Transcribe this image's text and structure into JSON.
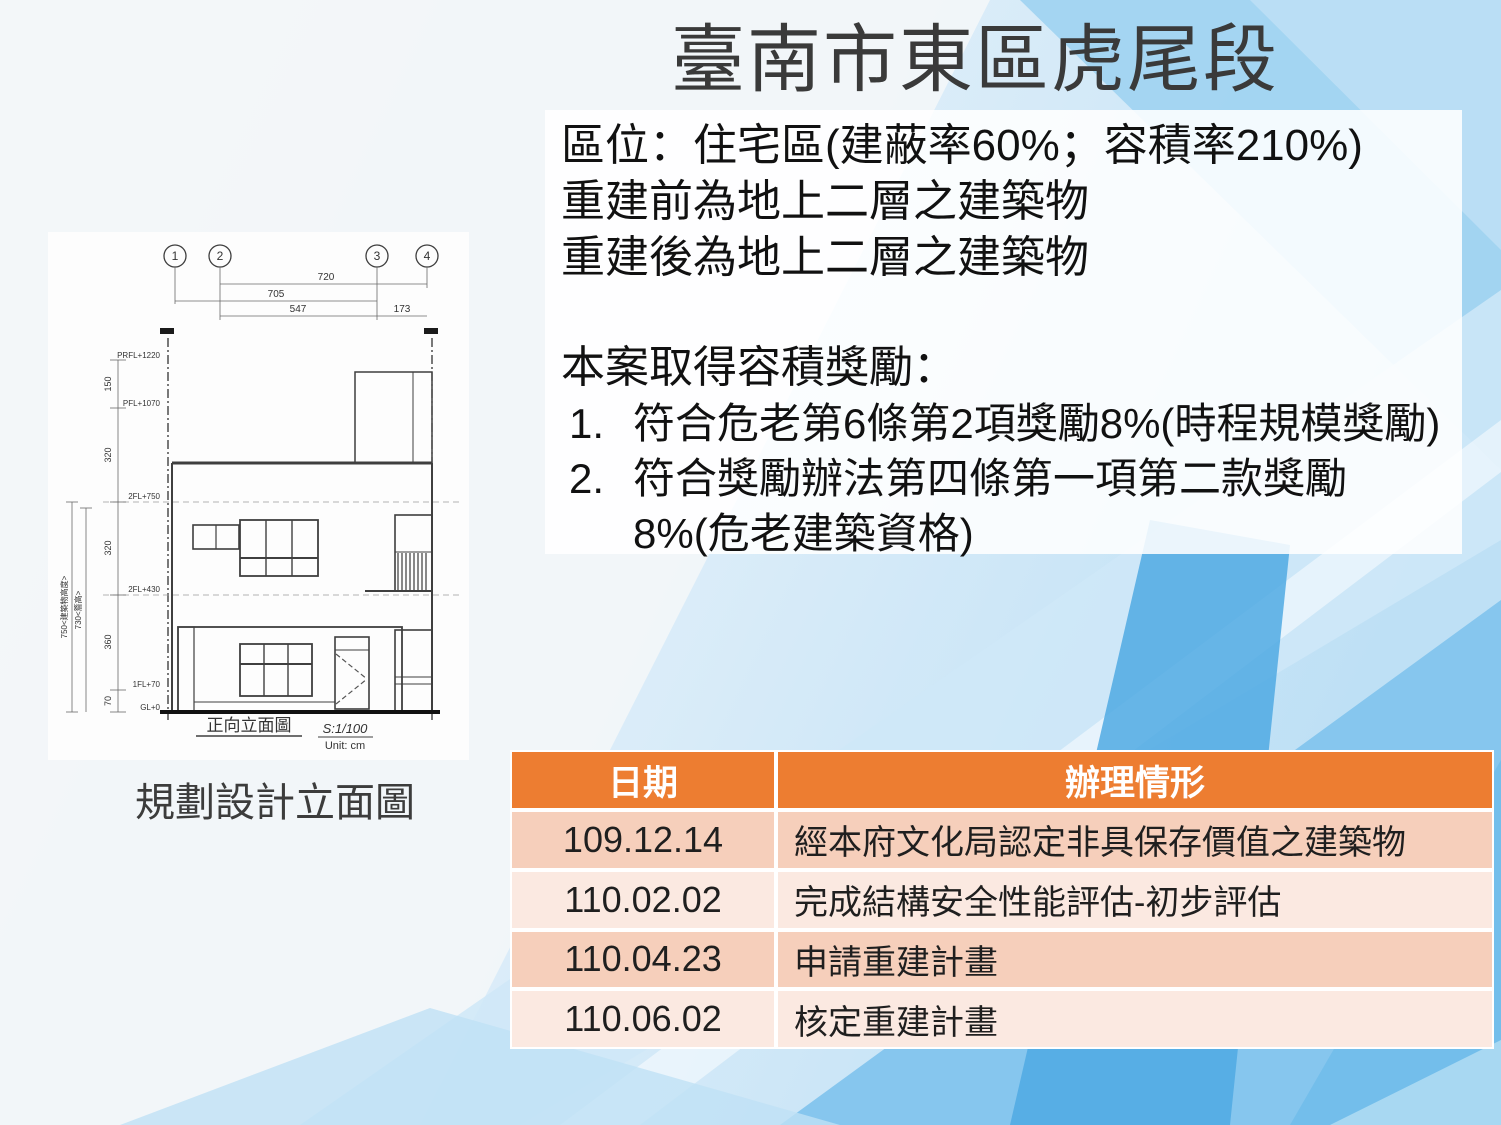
{
  "slide": {
    "title": "臺南市東區虎尾段",
    "info_lines": [
      "區位：住宅區(建蔽率60%；容積率210%)",
      "重建前為地上二層之建築物",
      "重建後為地上二層之建築物"
    ],
    "bonus": {
      "heading": "本案取得容積獎勵：",
      "items": [
        {
          "num": "1.",
          "lines": [
            "符合危老第6條第2項獎勵8%(時程規模獎勵)",
            ""
          ]
        },
        {
          "num": "2.",
          "lines": [
            "符合獎勵辦法第四條第一項第二款獎勵",
            "8%(危老建築資格)"
          ]
        }
      ]
    }
  },
  "drawing": {
    "caption": "規劃設計立面圖",
    "plan_title": "正向立面圖",
    "scale": "S:1/100",
    "unit": "Unit: cm",
    "grid_labels": [
      "1",
      "2",
      "3",
      "4"
    ],
    "dims_top": [
      "720",
      "705",
      "547",
      "173"
    ],
    "levels": [
      "PRFL+1220",
      "PFL+1070",
      "2FL+750",
      "2FL+430",
      "1FL+70",
      "GL+0"
    ],
    "seg_heights": [
      "150",
      "320",
      "320",
      "360",
      "70"
    ],
    "overall_heights": [
      "750<建築物高度>",
      "730<簷高>"
    ]
  },
  "table": {
    "headers": [
      "日期",
      "辦理情形"
    ],
    "rows": [
      {
        "date": "109.12.14",
        "status": "經本府文化局認定非具保存價值之建築物"
      },
      {
        "date": "110.02.02",
        "status": "完成結構安全性能評估-初步評估"
      },
      {
        "date": "110.04.23",
        "status": "申請重建計畫"
      },
      {
        "date": "110.06.02",
        "status": "核定重建計畫"
      }
    ]
  },
  "colors": {
    "accent_orange": "#ED7D31",
    "band_dark": "#F6CFBB",
    "band_light": "#FBE9E1",
    "bg_blue_light": "#D9ECF9",
    "bg_blue_mid": "#9FD3F1",
    "bg_blue_deep": "#5FB3E8",
    "title_text": "#3A3A3A",
    "body_text": "#111111"
  }
}
